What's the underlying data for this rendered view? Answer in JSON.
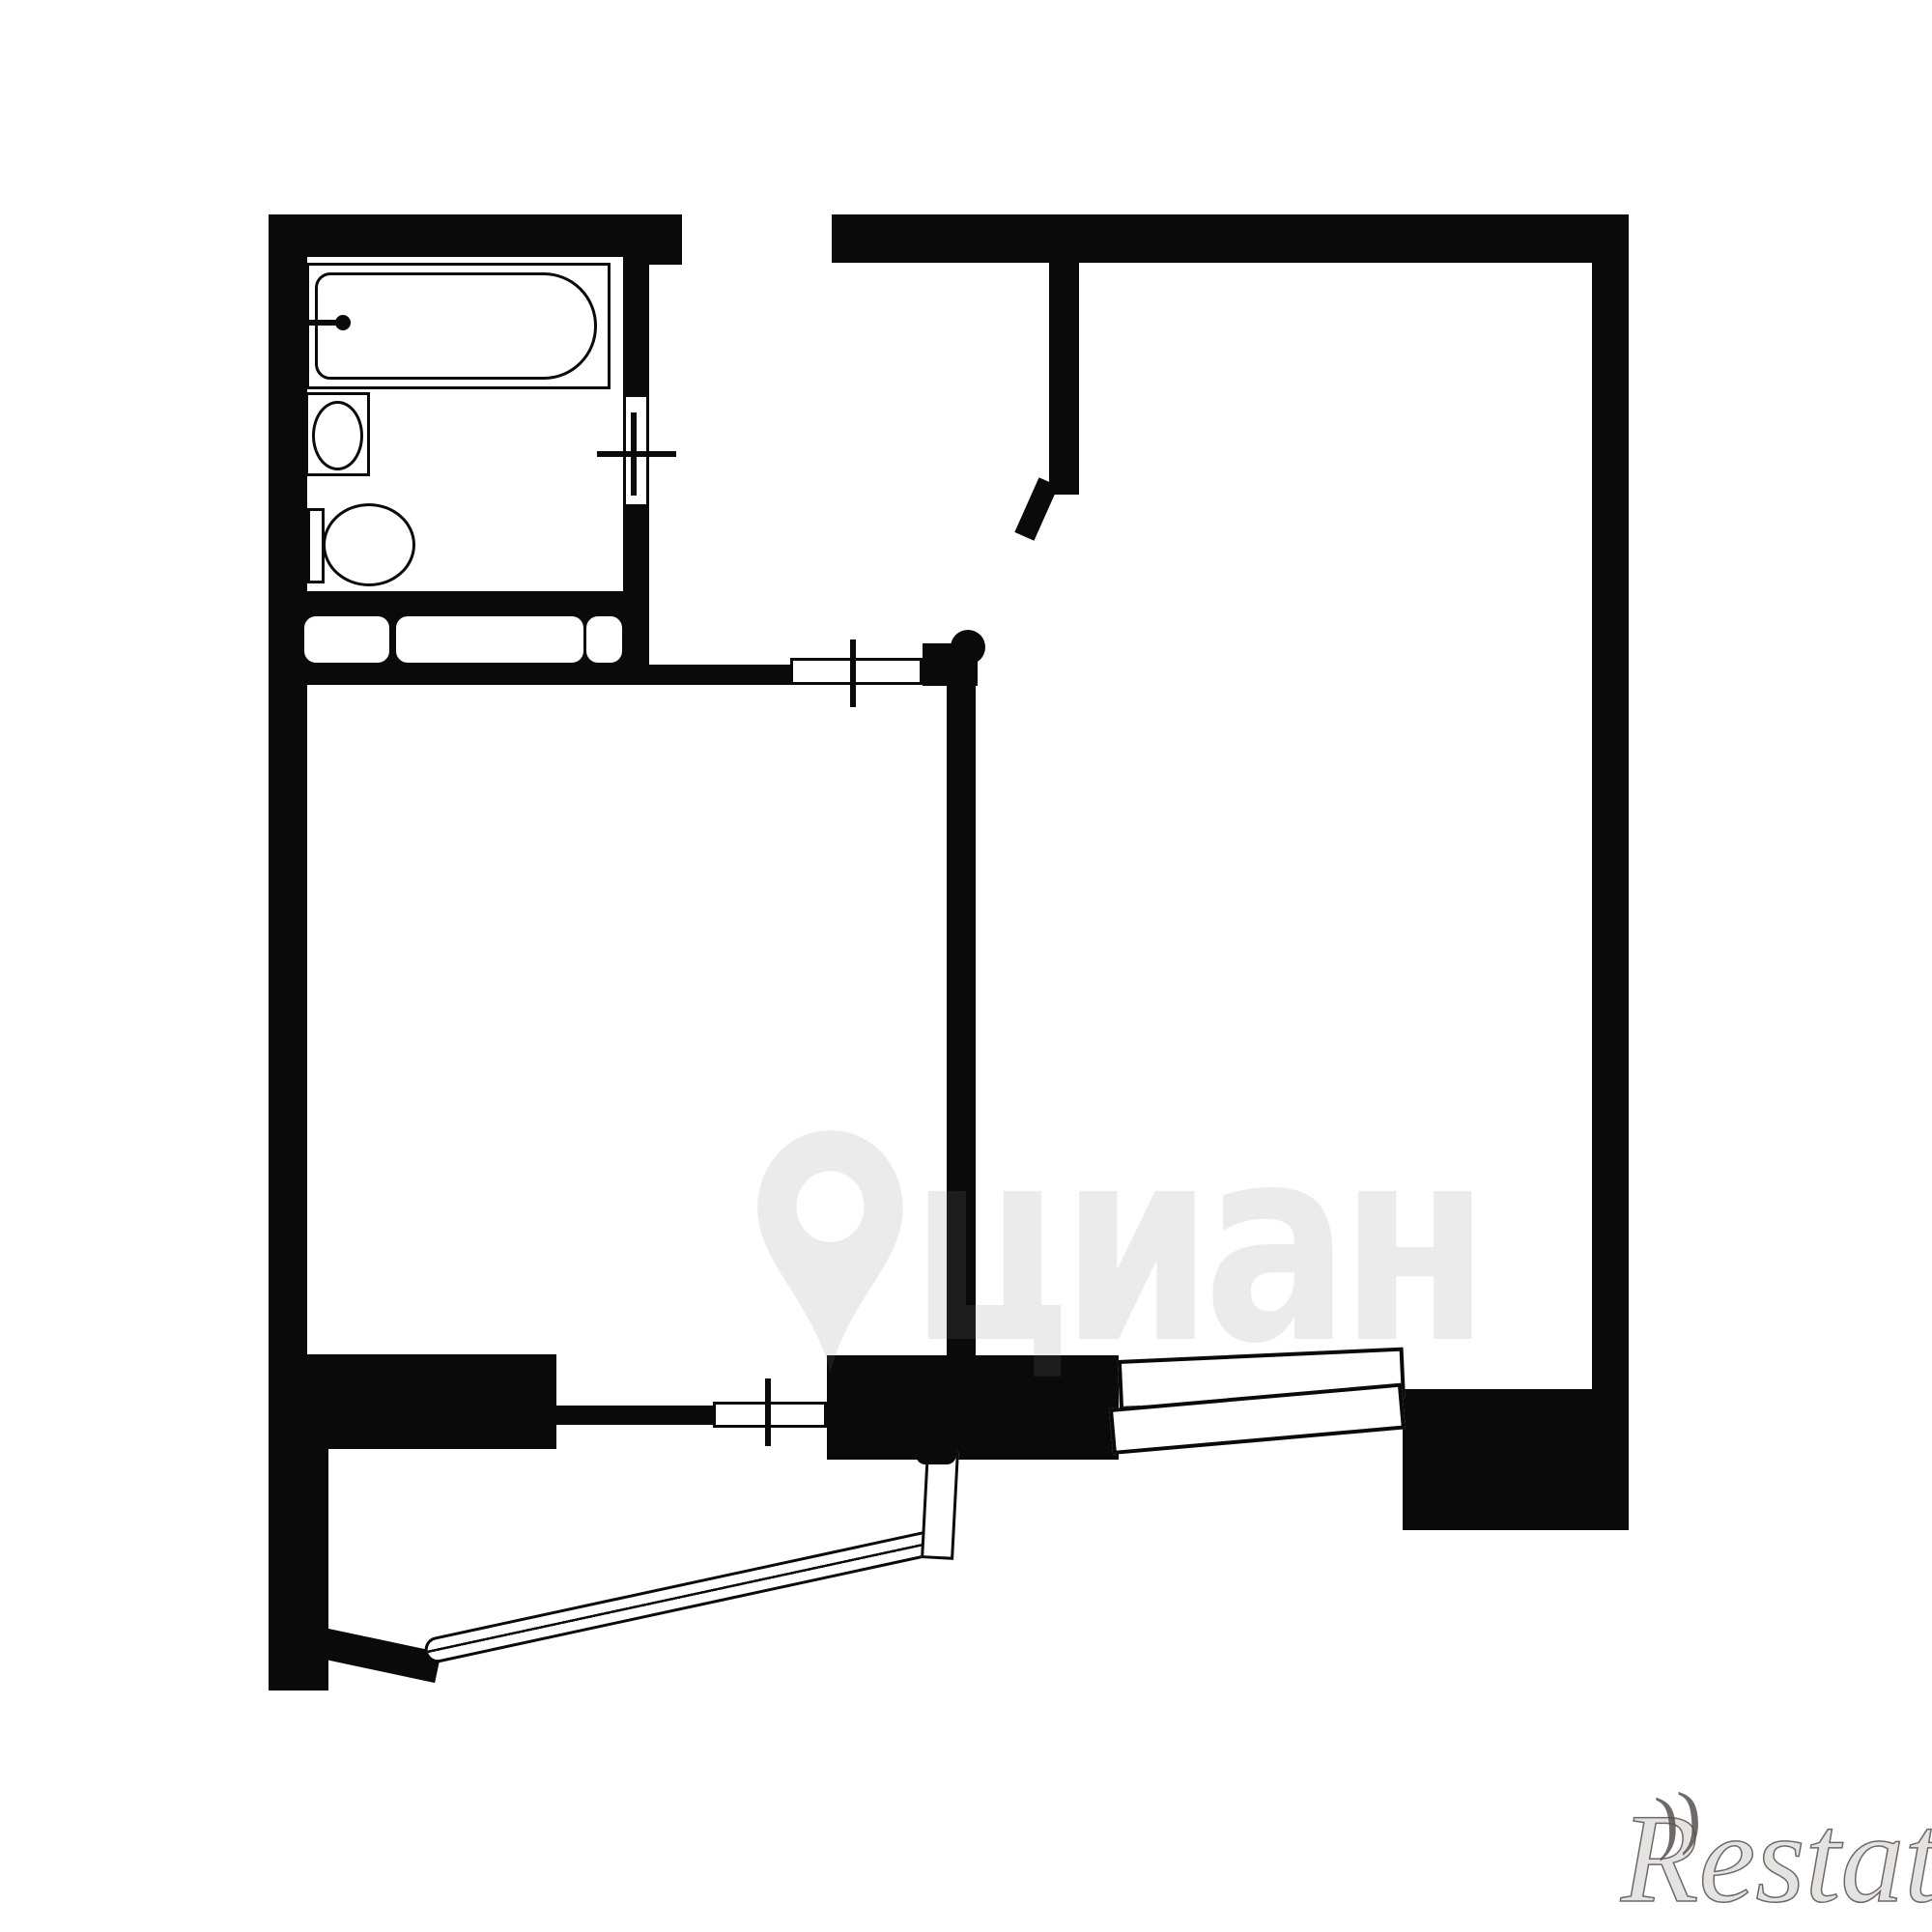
{
  "image_type": "black-and-white apartment floor plan (BTI scheme), one-room flat with balcony",
  "colors": {
    "background": "#ffffff",
    "walls": "#0a0a0a",
    "cian_watermark": "rgba(128,128,128,0.16)",
    "restate_watermark": "#6b6661"
  },
  "watermarks": {
    "cian": {
      "text": "циан",
      "icon": "map-pin-icon"
    },
    "restate": {
      "text": "Restate",
      "flourish": "))"
    }
  },
  "rooms": [
    "bathroom",
    "hallway",
    "living-room",
    "right-room",
    "balcony"
  ],
  "fixtures": [
    {
      "icon": "bathtub-icon",
      "location": "bathroom top"
    },
    {
      "icon": "washbasin-icon",
      "location": "bathroom left middle"
    },
    {
      "icon": "toilet-icon",
      "location": "bathroom left bottom"
    },
    {
      "icon": "closet-shelves-icon",
      "location": "hallway strip below bathroom"
    },
    {
      "icon": "window-cross-icon",
      "location": "bathroom door"
    },
    {
      "icon": "window-cross-icon",
      "location": "hall opening to right room"
    },
    {
      "icon": "window-cross-icon",
      "location": "balcony door"
    },
    {
      "icon": "door-swing-icon",
      "location": "right room entry partition"
    },
    {
      "icon": "double-window-icon",
      "location": "right room bottom exterior wall"
    },
    {
      "icon": "balcony-railing-icon",
      "location": "balcony bottom left"
    }
  ]
}
